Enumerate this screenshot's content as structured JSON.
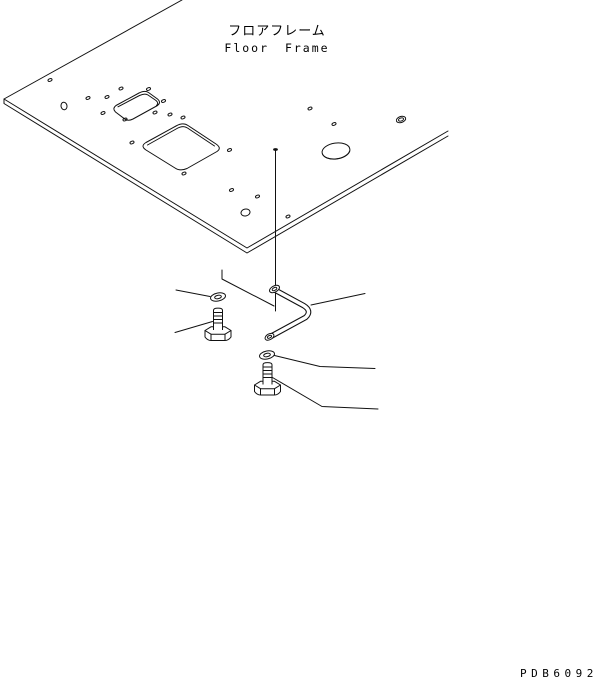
{
  "title": {
    "jp": "フロアフレーム",
    "en": "Floor Frame"
  },
  "footer": {
    "part_code": "PDB6092"
  },
  "drawing": {
    "type": "exploded-parts-diagram",
    "line_color": "#111111",
    "background_color": "#ffffff",
    "components": [
      "floor-frame-panel",
      "small-cutout",
      "large-cutout",
      "bolt-holes",
      "bent-rod",
      "washer-upper",
      "bolt-upper",
      "washer-lower",
      "bolt-lower",
      "leader-lines"
    ]
  }
}
